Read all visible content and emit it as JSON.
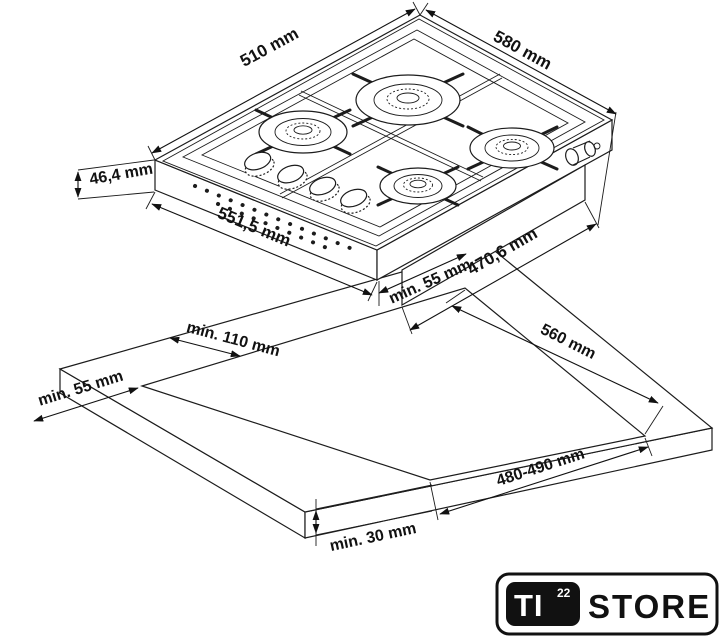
{
  "diagram": {
    "type": "gas-hob-installation-drawing",
    "colors": {
      "line": "#1c1c1c",
      "background": "#ffffff"
    },
    "labels": {
      "hob_width": "510 mm",
      "hob_depth": "580 mm",
      "hob_height": "46,4 mm",
      "hob_body_width": "551,5 mm",
      "hob_body_depth": "470,6 mm",
      "clearance_rear": "min. 55 mm",
      "clearance_back_edge": "min. 110 mm",
      "clearance_side": "min. 55 mm",
      "cutout_depth": "560 mm",
      "cutout_width": "480-490 mm",
      "worktop_thickness": "min. 30 mm"
    }
  },
  "logo": {
    "ti": "TI",
    "sup": "22",
    "store": "STORE"
  }
}
